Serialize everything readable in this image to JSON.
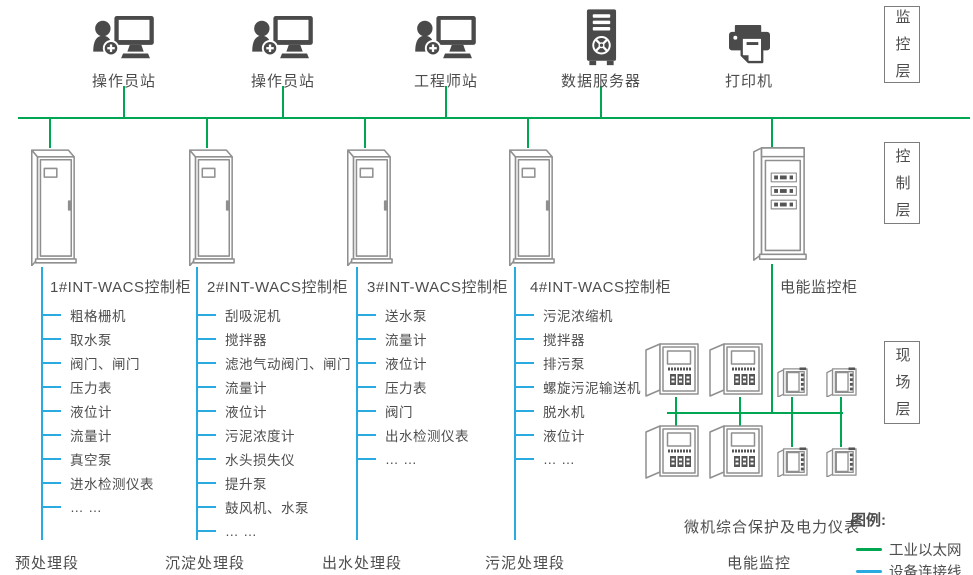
{
  "colors": {
    "industrial_ethernet": "#00a651",
    "device_connection": "#29abe2",
    "text": "#4d4d4d",
    "icon": "#4a4a4a",
    "cabinet_outline": "#8f8f8f"
  },
  "layers": [
    {
      "id": "monitoring",
      "label": "监控层"
    },
    {
      "id": "control",
      "label": "控制层"
    },
    {
      "id": "field",
      "label": "现场层"
    }
  ],
  "stations": [
    {
      "id": "operator-station-1",
      "label": "操作员站",
      "icon": "operator-workstation-icon",
      "connected": true
    },
    {
      "id": "operator-station-2",
      "label": "操作员站",
      "icon": "operator-workstation-icon",
      "connected": true
    },
    {
      "id": "engineer-station",
      "label": "工程师站",
      "icon": "engineer-workstation-icon",
      "connected": true
    },
    {
      "id": "data-server",
      "label": "数据服务器",
      "icon": "server-tower-icon",
      "connected": true
    },
    {
      "id": "printer",
      "label": "打印机",
      "icon": "printer-icon",
      "connected": false
    }
  ],
  "cabinets": [
    {
      "id": "cabinet-1",
      "label": "1#INT-WACS控制柜",
      "section": "预处理段",
      "devices": [
        "粗格栅机",
        "取水泵",
        "阀门、闸门",
        "压力表",
        "液位计",
        "流量计",
        "真空泵",
        "进水检测仪表",
        "… …"
      ]
    },
    {
      "id": "cabinet-2",
      "label": "2#INT-WACS控制柜",
      "section": "沉淀处理段",
      "devices": [
        "刮吸泥机",
        "搅拌器",
        "滤池气动阀门、闸门",
        "流量计",
        "液位计",
        "污泥浓度计",
        "水头损失仪",
        "提升泵",
        "鼓风机、水泵",
        "… …"
      ]
    },
    {
      "id": "cabinet-3",
      "label": "3#INT-WACS控制柜",
      "section": "出水处理段",
      "devices": [
        "送水泵",
        "流量计",
        "液位计",
        "压力表",
        "阀门",
        "出水检测仪表",
        "… …"
      ]
    },
    {
      "id": "cabinet-4",
      "label": "4#INT-WACS控制柜",
      "section": "污泥处理段",
      "devices": [
        "污泥浓缩机",
        "搅拌器",
        "排污泵",
        "螺旋污泥输送机",
        "脱水机",
        "液位计",
        "… …"
      ]
    }
  ],
  "power_monitoring": {
    "cabinet_label": "电能监控柜",
    "meters_caption": "微机综合保护及电力仪表",
    "section_label": "电能监控"
  },
  "legend": {
    "title": "图例:",
    "items": [
      {
        "id": "industrial-ethernet",
        "label": "工业以太网",
        "color": "#00a651"
      },
      {
        "id": "device-connection",
        "label": "设备连接线",
        "color": "#29abe2"
      }
    ]
  }
}
